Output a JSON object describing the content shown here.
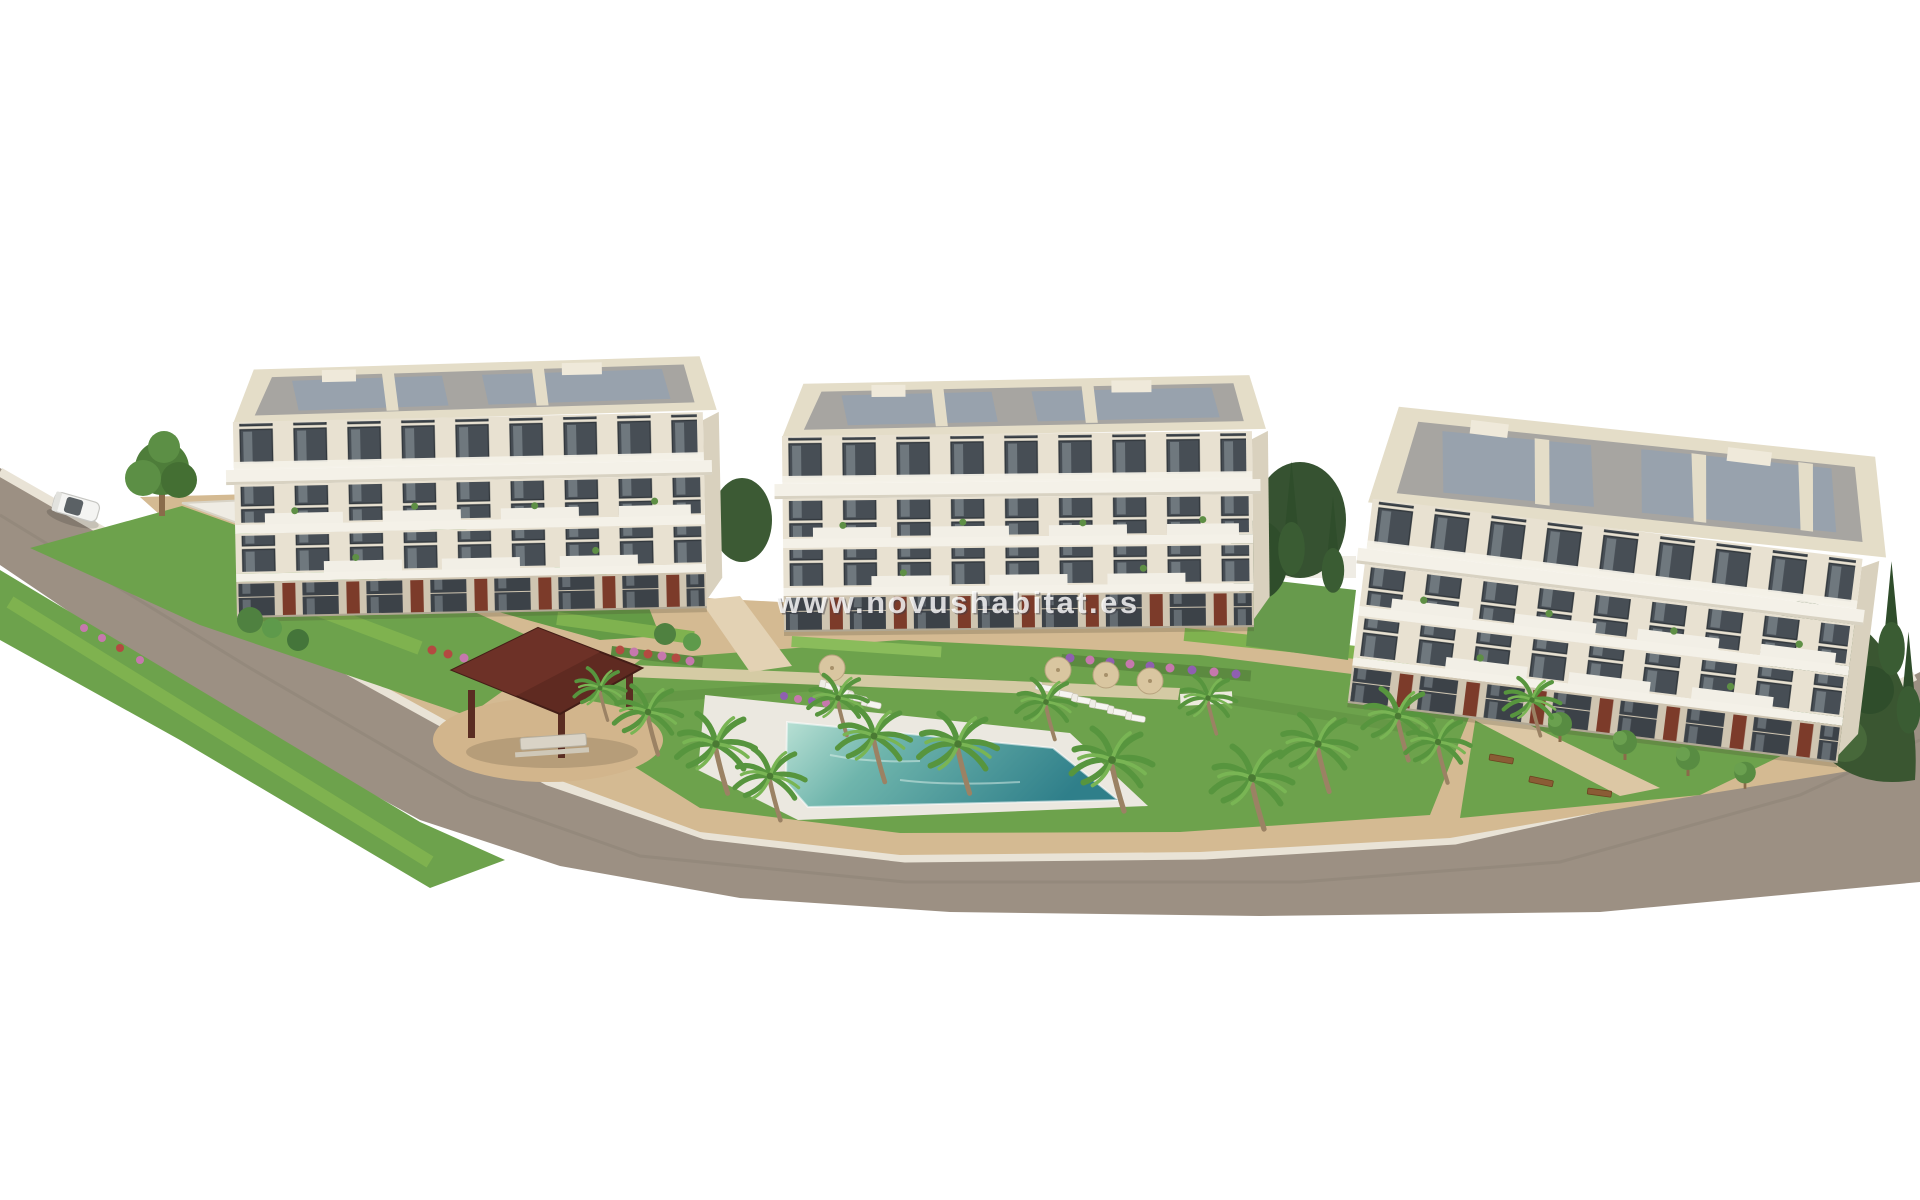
{
  "watermark": {
    "text": "www.novushabitat.es"
  },
  "palette": {
    "background": "#ffffff",
    "road": "#9c9083",
    "road_curb": "#e9e3d6",
    "lawn": "#6da24c",
    "lawn_dark": "#55873c",
    "hedge": "#7fb24f",
    "paving": "#d4ba92",
    "path_light": "#e3d2b4",
    "deck": "#ebe8e0",
    "pool_shallow": "#b8e0d4",
    "pool_deep": "#2f7f8a",
    "facade": "#e8e1d1",
    "facade_band": "#f4f1e8",
    "window_glass": "#474e55",
    "roof_frame": "#e4ddc8",
    "roof_gray": "#a7a5a1",
    "roof_panel": "#97a2ae",
    "terracotta": "#7c3b2a",
    "gazebo_roof": "#5f2a21",
    "tree_green": "#4e7d3a",
    "cypress_green": "#2f4d2b",
    "palm_green": "#57953e",
    "trunk_brown": "#9b8264",
    "flower_pink": "#c678ad",
    "flower_red": "#b34a41",
    "flower_purple": "#8f5fb0",
    "umbrella_tan": "#d9c6a0",
    "bench_brown": "#8a5c35",
    "car_white": "#f4f4f2",
    "watermark_white": "#ffffff"
  },
  "scene": {
    "type": "3d-architectural-render",
    "buildings": {
      "count": 3,
      "floors_each": 4,
      "style": "white residential blocks with balconies and terracotta accents"
    },
    "amenities": [
      "swimming-pool",
      "gazebo",
      "sun-loungers",
      "parasols",
      "benches",
      "driveway"
    ],
    "vegetation": [
      "palm-trees",
      "cypress-trees",
      "hedges",
      "lawns",
      "flower-beds",
      "deciduous-tree"
    ],
    "road": {
      "position": "left-and-bottom-perimeter",
      "car_count": 1
    }
  }
}
